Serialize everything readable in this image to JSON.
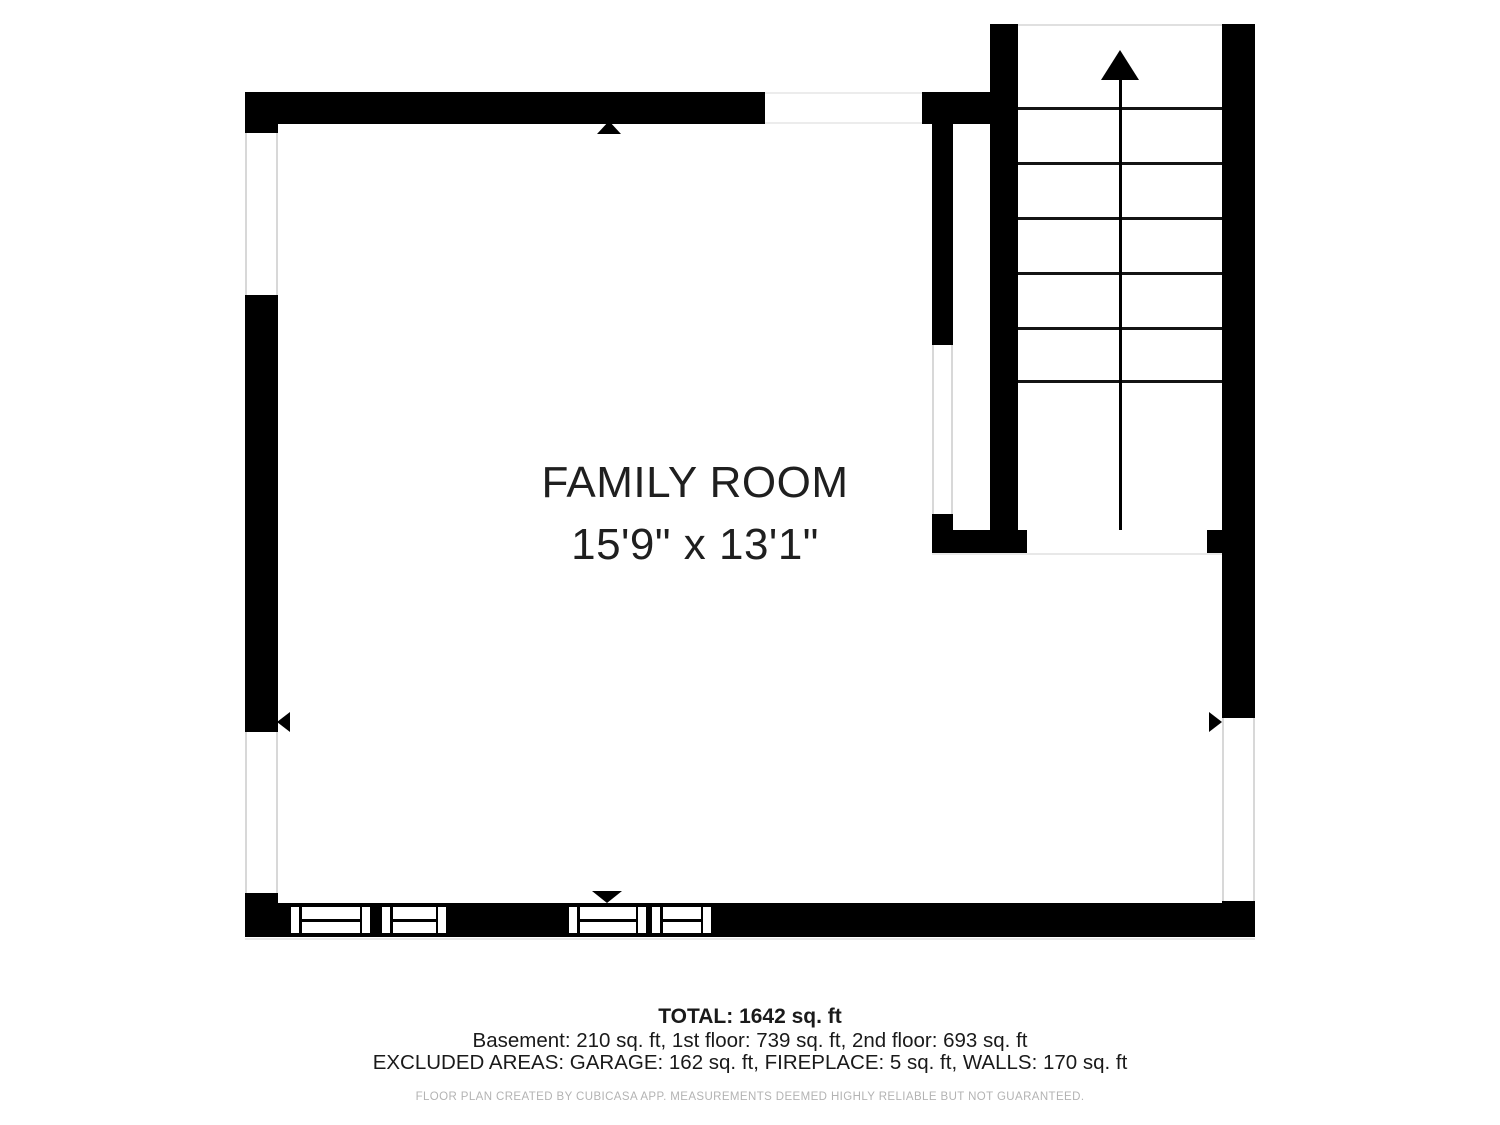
{
  "room": {
    "name": "FAMILY ROOM",
    "dimensions": "15'9\" x 13'1\""
  },
  "summary": {
    "total": "TOTAL: 1642 sq. ft",
    "floors": "Basement: 210 sq. ft, 1st floor: 739 sq. ft, 2nd floor: 693 sq. ft",
    "excluded": "EXCLUDED AREAS: GARAGE: 162 sq. ft, FIREPLACE: 5 sq. ft, WALLS: 170 sq. ft"
  },
  "footer": {
    "credit": "FLOOR PLAN CREATED BY CUBICASA APP. MEASUREMENTS DEEMED HIGHLY RELIABLE BUT NOT GUARANTEED."
  },
  "stairs": {
    "direction": "up",
    "step_count": 6,
    "icon": "up-arrow-icon"
  },
  "colors": {
    "wall": "#000000",
    "step_line": "#141414",
    "window_outline": "#d8d8d8",
    "room_text": "#1f1f1f",
    "summary_text": "#1a1a1a",
    "footer_text": "#b3b3b3",
    "background": "#ffffff"
  }
}
